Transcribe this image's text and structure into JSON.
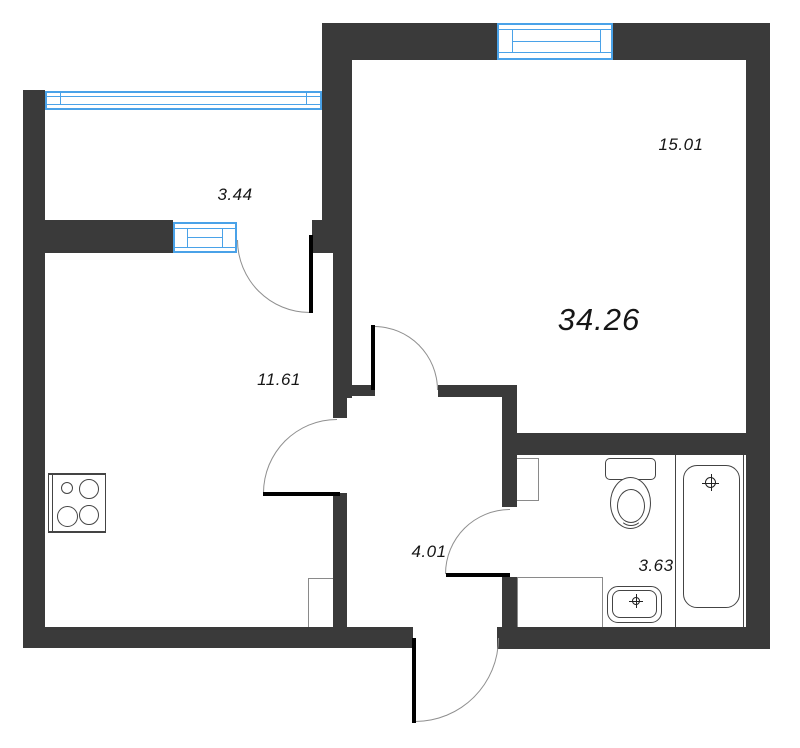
{
  "plan": {
    "type": "apartment floor plan",
    "total_area": "34.26",
    "rooms": [
      {
        "name": "living-room",
        "area": "15.01"
      },
      {
        "name": "balcony",
        "area": "3.44"
      },
      {
        "name": "kitchen-living",
        "area": "11.61"
      },
      {
        "name": "hallway",
        "area": "4.01"
      },
      {
        "name": "bathroom",
        "area": "3.63"
      }
    ],
    "fixtures": [
      "stove",
      "toilet",
      "bathtub",
      "sink",
      "washer-niche",
      "duct-shaft"
    ],
    "colors": {
      "wall": "#3a3a3a",
      "window": "#4aa2e8",
      "fixture_line": "#444444",
      "thin_line": "#8a8a8a",
      "door_leaf": "#000000",
      "door_arc": "#8f8f8f",
      "label": "#161616",
      "background": "#ffffff"
    }
  }
}
